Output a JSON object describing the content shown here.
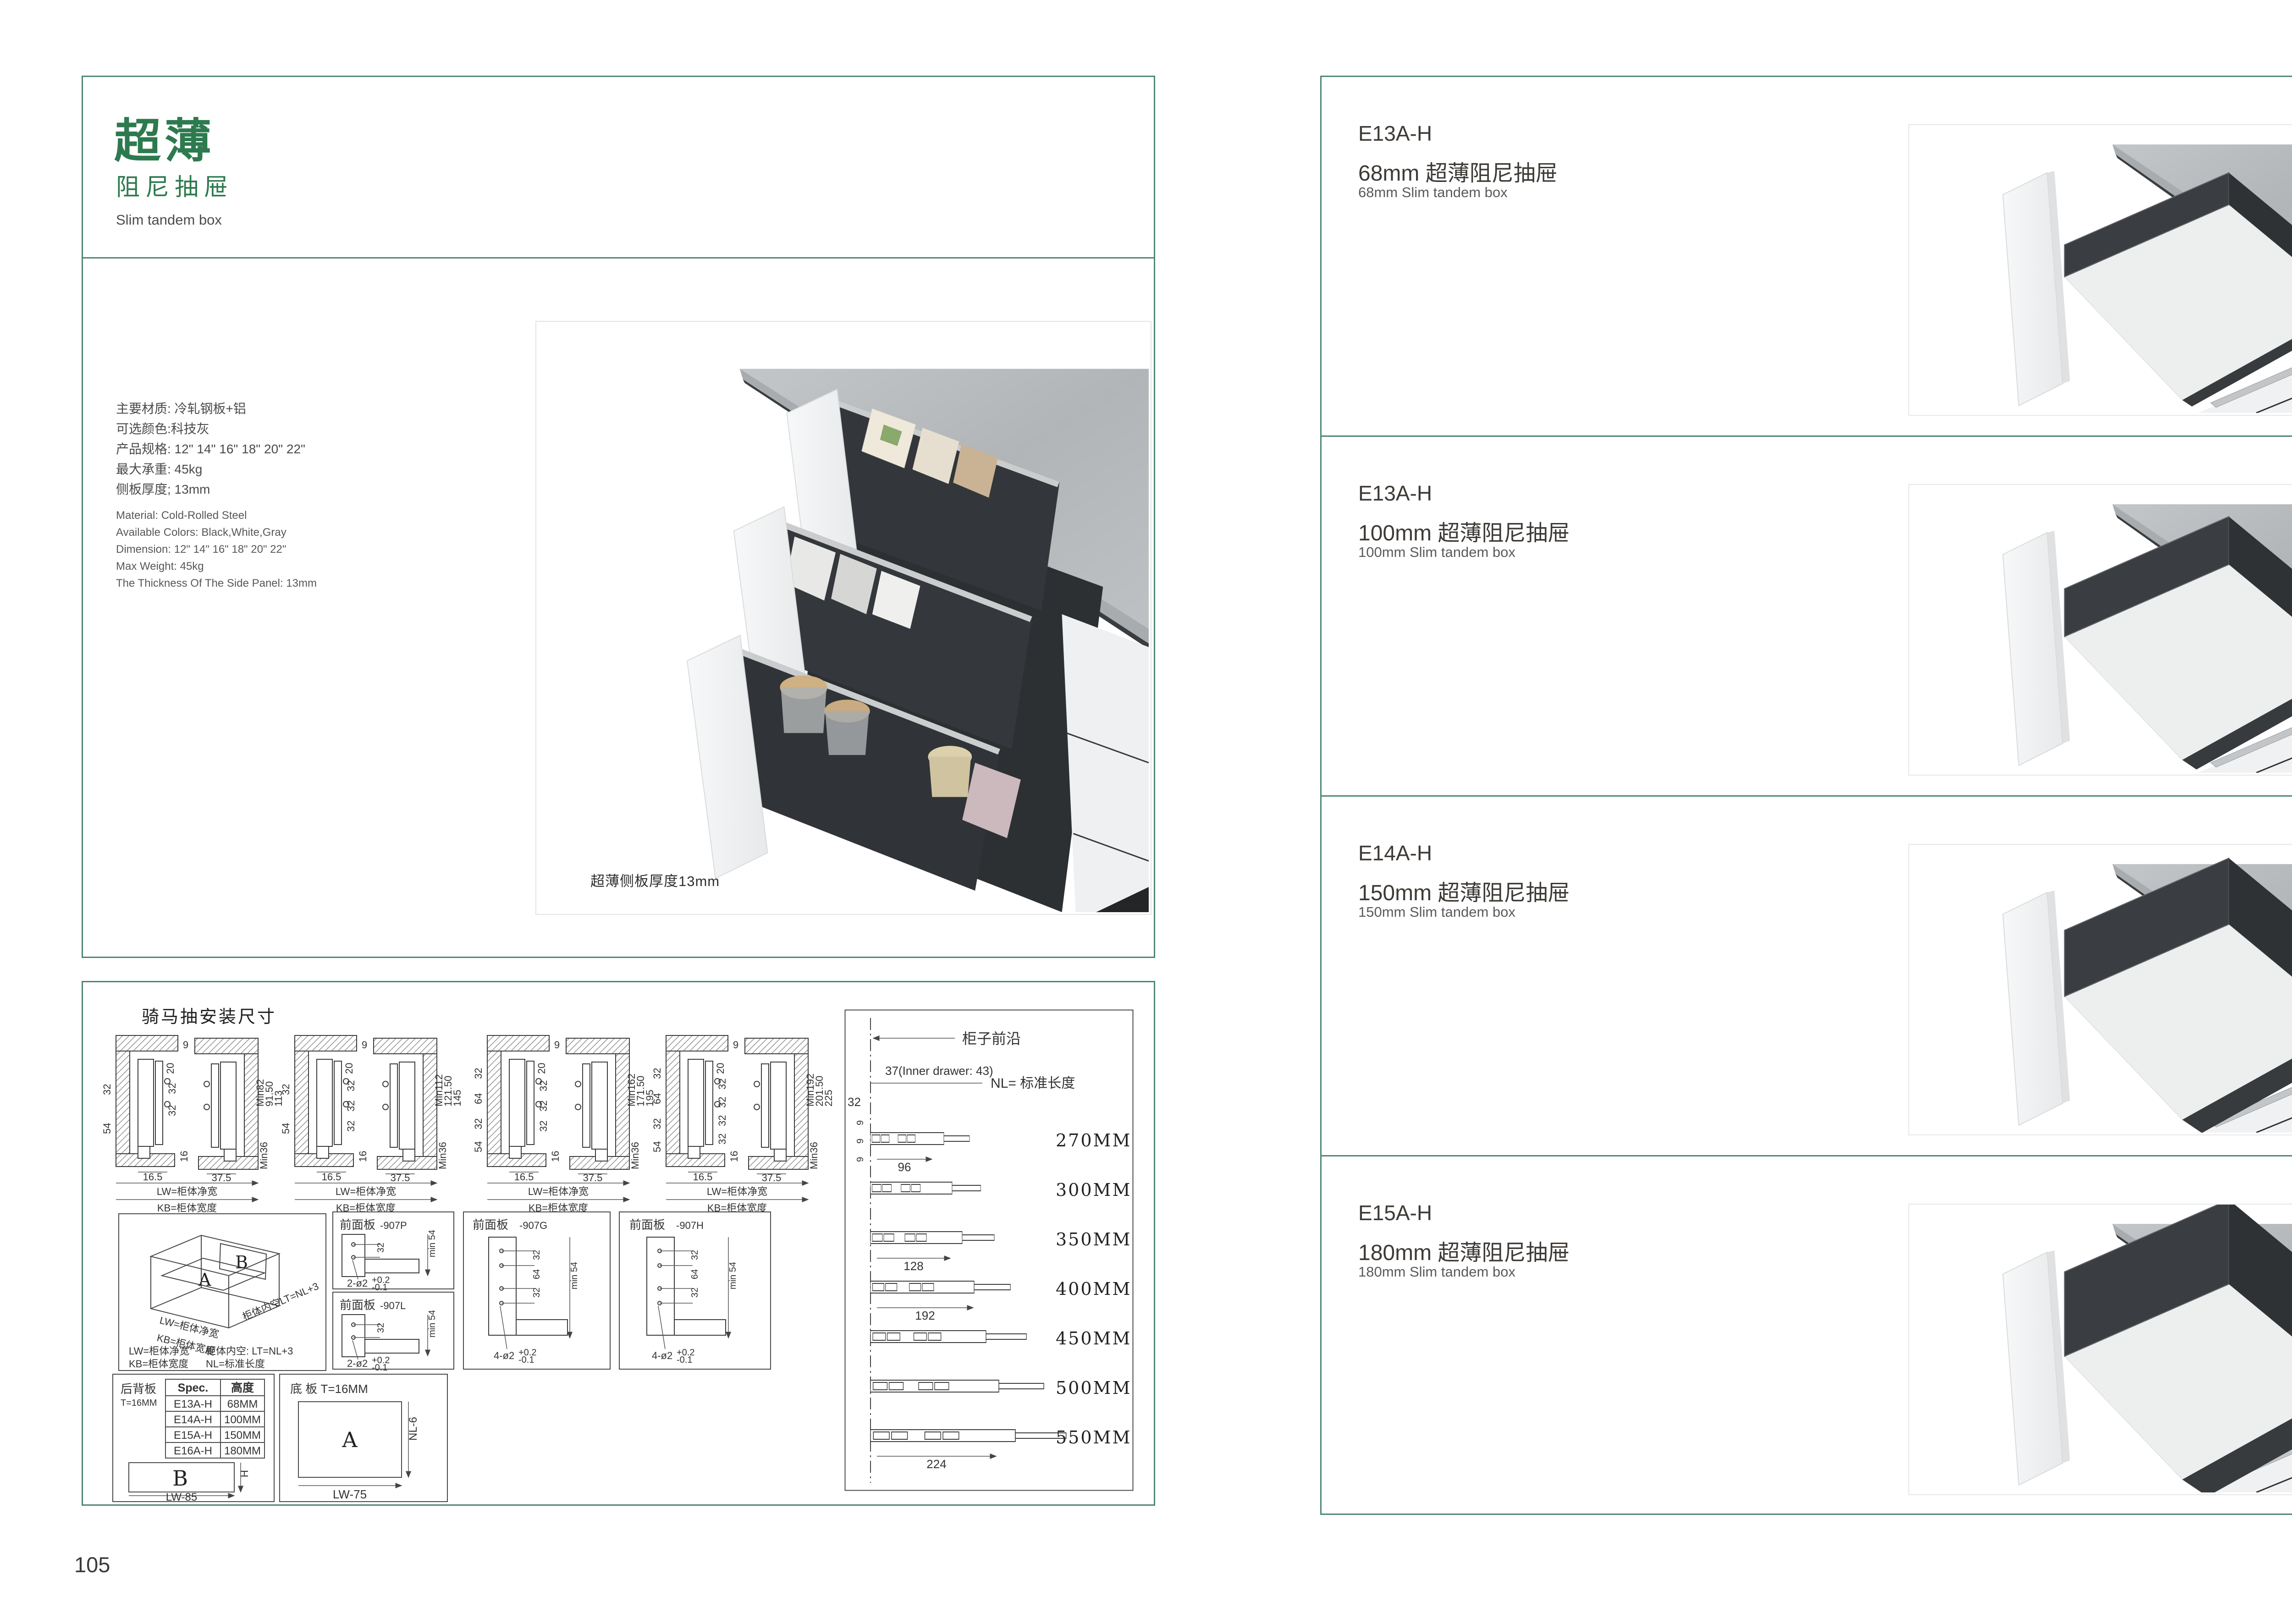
{
  "colors": {
    "accent_green": "#2d7a4e",
    "border_green": "#4f8673",
    "text_dark": "#3d3935",
    "text_gray": "#5a5a5a",
    "countertop_gray": "#b7babc",
    "drawer_dark": "#34373a"
  },
  "page_left": {
    "page_number": "105",
    "title_cn": "超薄",
    "subtitle_cn": "阻尼抽屉",
    "subtitle_en": "Slim tandem box",
    "specs_cn": [
      "主要材质: 冷轧钢板+铝",
      "可选颜色:科技灰",
      "产品规格: 12\" 14\" 16\" 18\" 20\" 22\"",
      "最大承重: 45kg",
      "侧板厚度; 13mm"
    ],
    "specs_en": [
      "Material: Cold-Rolled Steel",
      "Available Colors: Black,White,Gray",
      "Dimension: 12\" 14\" 16\" 18\" 20\" 22\"",
      "Max Weight: 45kg",
      "The Thickness Of The Side Panel: 13mm"
    ],
    "photo_caption": "超薄侧板厚度13mm"
  },
  "drawings": {
    "header": "骑马抽安装尺寸",
    "cross_sections": [
      {
        "top": [
          "9",
          "20"
        ],
        "holes": [
          "32",
          "32"
        ],
        "center": "16",
        "left": [
          "32",
          "54"
        ],
        "right": [
          "Min82",
          "91.50",
          "113"
        ],
        "corner": "Min36",
        "bottom": [
          "16.5",
          "37.5"
        ],
        "lw": "LW=柜体净宽",
        "kb": "KB=柜体宽度"
      },
      {
        "top": [
          "9",
          "20"
        ],
        "holes": [
          "32",
          "32",
          "32"
        ],
        "center": "16",
        "left": [
          "32",
          "54"
        ],
        "right": [
          "Min112",
          "121.50",
          "145"
        ],
        "corner": "Min36",
        "bottom": [
          "16.5",
          "37.5"
        ],
        "lw": "LW=柜体净宽",
        "kb": "KB=柜体宽度"
      },
      {
        "top": [
          "9",
          "20"
        ],
        "holes": [
          "32",
          "32",
          "32"
        ],
        "center": "16",
        "left": [
          "32",
          "64",
          "32",
          "54"
        ],
        "right": [
          "Min162",
          "171.50",
          "195"
        ],
        "corner": "Min36",
        "bottom": [
          "16.5",
          "37.5"
        ],
        "lw": "LW=柜体净宽",
        "kb": "KB=柜体宽度"
      },
      {
        "top": [
          "9",
          "20"
        ],
        "holes": [
          "32",
          "32",
          "32",
          "32"
        ],
        "center": "16",
        "left": [
          "32",
          "64",
          "32",
          "54"
        ],
        "right": [
          "Min192",
          "201.50",
          "225"
        ],
        "corner": "Min36",
        "bottom": [
          "16.5",
          "37.5"
        ],
        "lw": "LW=柜体净宽",
        "kb": "KB=柜体宽度"
      }
    ],
    "nl_panel": {
      "front_edge": "柜子前沿",
      "setback": "37(Inner drawer: 43)",
      "dim32": "32",
      "dim9": "9",
      "nl_eq": "NL= 标准长度",
      "lengths": [
        "270MM",
        "300MM",
        "350MM",
        "400MM",
        "450MM",
        "500MM",
        "550MM"
      ],
      "pitches": [
        "96",
        "128",
        "192",
        "224"
      ]
    },
    "iso": {
      "b": "B",
      "a": "A",
      "lw": "LW=柜体净宽",
      "kb": "KB=柜体宽度",
      "lt": "柜体内空LT=NL+3",
      "note1a": "LW=柜体净宽",
      "note1b": "柜体内空: LT=NL+3",
      "note2a": "KB=柜体宽度",
      "note2b": "NL=标准长度"
    },
    "front_panels": [
      {
        "title": "前面板",
        "code": "-907P",
        "dim": "32",
        "min": "min 54",
        "callout": "2-ø2",
        "tol_plus": "+0.2",
        "tol_minus": "-0.1"
      },
      {
        "title": "前面板",
        "code": "-907L",
        "dim": "32",
        "min": "min 54",
        "callout": "2-ø2",
        "tol_plus": "+0.2",
        "tol_minus": "-0.1"
      },
      {
        "title": "前面板",
        "code": "-907G",
        "dims": [
          "32",
          "64",
          "32"
        ],
        "min": "min 54",
        "callout": "4-ø2",
        "tol_plus": "+0.2",
        "tol_minus": "-0.1"
      },
      {
        "title": "前面板",
        "code": "-907H",
        "dims": [
          "32",
          "64",
          "32"
        ],
        "min": "min 54",
        "callout": "4-ø2",
        "tol_plus": "+0.2",
        "tol_minus": "-0.1"
      }
    ],
    "back_panel": {
      "name": "后背板",
      "thickness": "T=16MM",
      "col_spec": "Spec.",
      "col_height": "高度",
      "rows": [
        [
          "E13A-H",
          "68MM"
        ],
        [
          "E14A-H",
          "100MM"
        ],
        [
          "E15A-H",
          "150MM"
        ],
        [
          "E16A-H",
          "180MM"
        ]
      ],
      "b": "B",
      "h": "H",
      "w": "LW-85"
    },
    "bottom_panel": {
      "title": "底 板 T=16MM",
      "a": "A",
      "nl": "NL-6",
      "w": "LW-75"
    }
  },
  "page_right": {
    "page_number": "106",
    "products": [
      {
        "code": "E13A-H",
        "name_cn": "68mm 超薄阻尼抽屉",
        "name_en": "68mm Slim tandem box"
      },
      {
        "code": "E13A-H",
        "name_cn": "100mm 超薄阻尼抽屉",
        "name_en": "100mm Slim tandem box"
      },
      {
        "code": "E14A-H",
        "name_cn": "150mm 超薄阻尼抽屉",
        "name_en": "150mm Slim tandem box"
      },
      {
        "code": "E15A-H",
        "name_cn": "180mm 超薄阻尼抽屉",
        "name_en": "180mm Slim tandem box"
      }
    ]
  }
}
